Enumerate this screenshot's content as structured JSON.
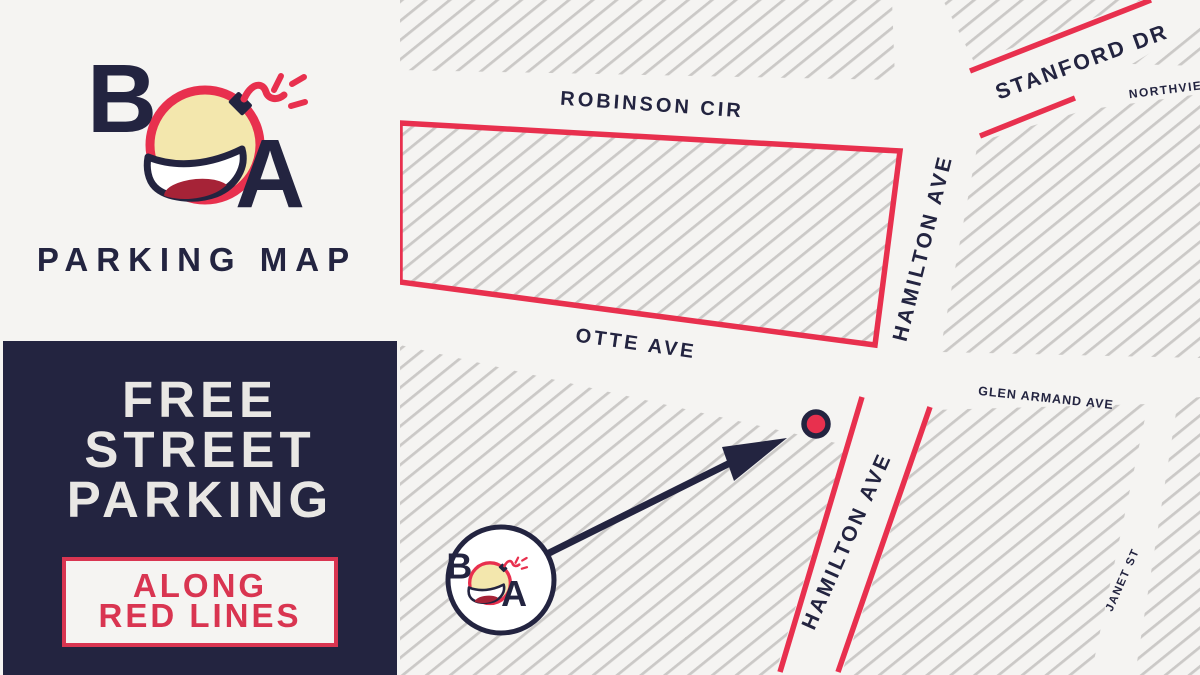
{
  "branding": {
    "letter_b": "B",
    "letter_a": "A",
    "wordmark": "PARKING MAP"
  },
  "promo": {
    "headline_lines": [
      "FREE",
      "STREET",
      "PARKING"
    ],
    "callout_lines": [
      "ALONG",
      "RED LINES"
    ]
  },
  "map": {
    "street_labels": {
      "robinson": "ROBINSON CIR",
      "otte": "OTTE AVE",
      "hamilton_upper": "HAMILTON AVE",
      "hamilton_lower": "HAMILTON AVE",
      "stanford": "STANFORD DR",
      "northview": "NORTHVIEW",
      "glen_armand": "GLEN ARMAND AVE",
      "janet": "JANET ST"
    }
  },
  "colors": {
    "navy": "#232440",
    "parking_red": "#e8304e",
    "accent_red": "#d93551",
    "background": "#f5f4f2",
    "hatch_gray": "#cbc9c7",
    "bomb_yellow": "#f3e7ad",
    "tongue_red": "#a62337",
    "headline_white": "#e9e7e4"
  }
}
